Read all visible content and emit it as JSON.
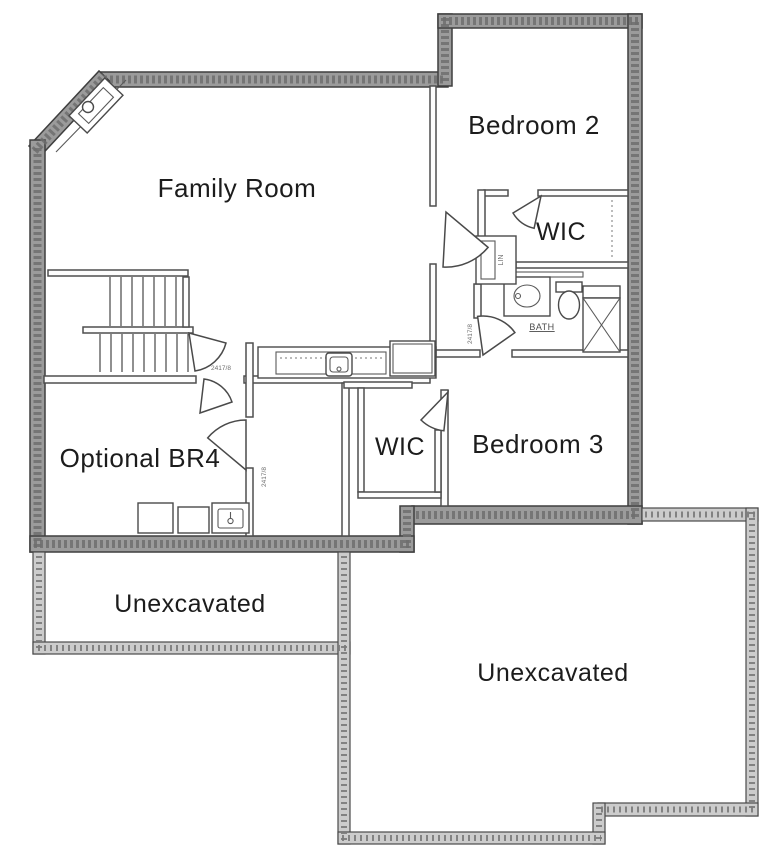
{
  "rooms": {
    "family_room": "Family Room",
    "bedroom_2": "Bedroom 2",
    "wic_upper": "WIC",
    "bath": "BATH",
    "bedroom_3": "Bedroom 3",
    "wic_lower": "WIC",
    "optional_br4": "Optional BR4",
    "unexcavated_left": "Unexcavated",
    "unexcavated_right": "Unexcavated"
  },
  "annotations": {
    "stair_door_dim": "2417/8",
    "bath_door_dim": "2417/8",
    "br4_door_dim": "2417/8",
    "linen_closet": "LIN"
  },
  "colors": {
    "paper": "#ffffff",
    "line": "#444444",
    "foundation_wall": "#9b9b9b",
    "unexcavated_wall": "#cccccc",
    "label_text": "#1c1c1c"
  }
}
